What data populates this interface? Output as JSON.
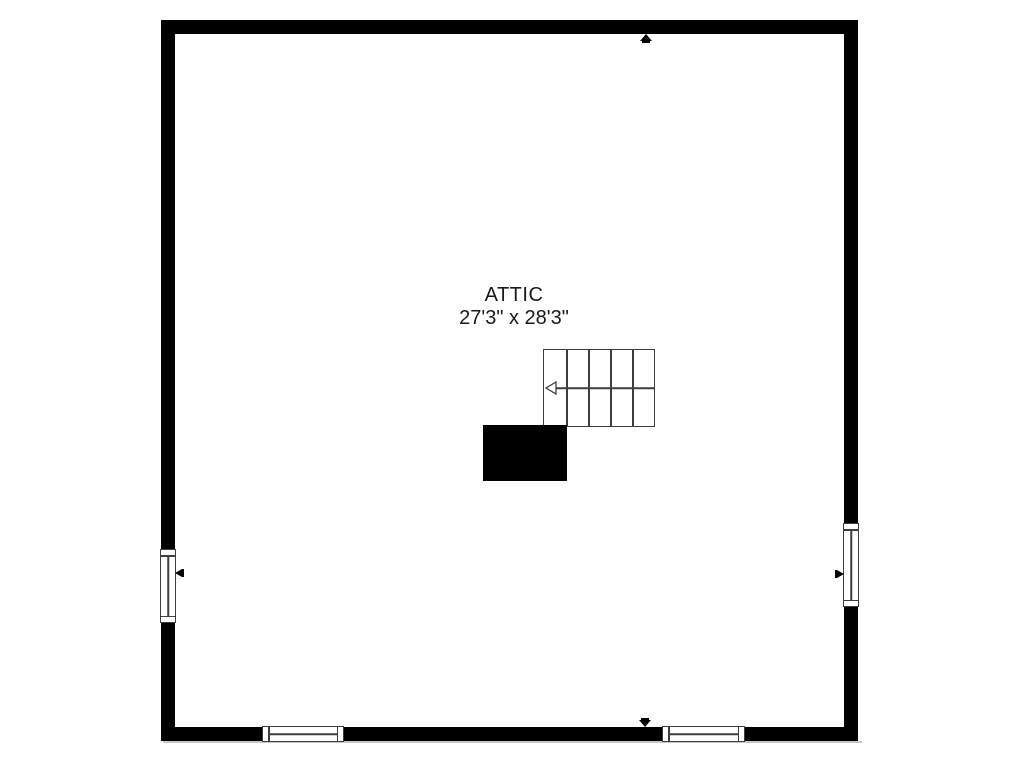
{
  "floor_plan": {
    "room": {
      "label": "ATTIC",
      "dimensions": "27'3\" x 28'3\""
    },
    "colors": {
      "wall": "#000000",
      "thin_line": "#3d3d3d",
      "background": "#ffffff",
      "stairwell_void": "#000000"
    },
    "stairs": {
      "treads": 5,
      "run_arrow_direction": "left"
    },
    "windows": [
      {
        "wall": "left"
      },
      {
        "wall": "right"
      },
      {
        "wall": "bottom-left"
      },
      {
        "wall": "bottom-right"
      }
    ],
    "markers": [
      {
        "side": "top",
        "points": "up"
      },
      {
        "side": "left",
        "points": "left"
      },
      {
        "side": "right",
        "points": "right"
      },
      {
        "side": "bottom",
        "points": "down"
      }
    ]
  }
}
